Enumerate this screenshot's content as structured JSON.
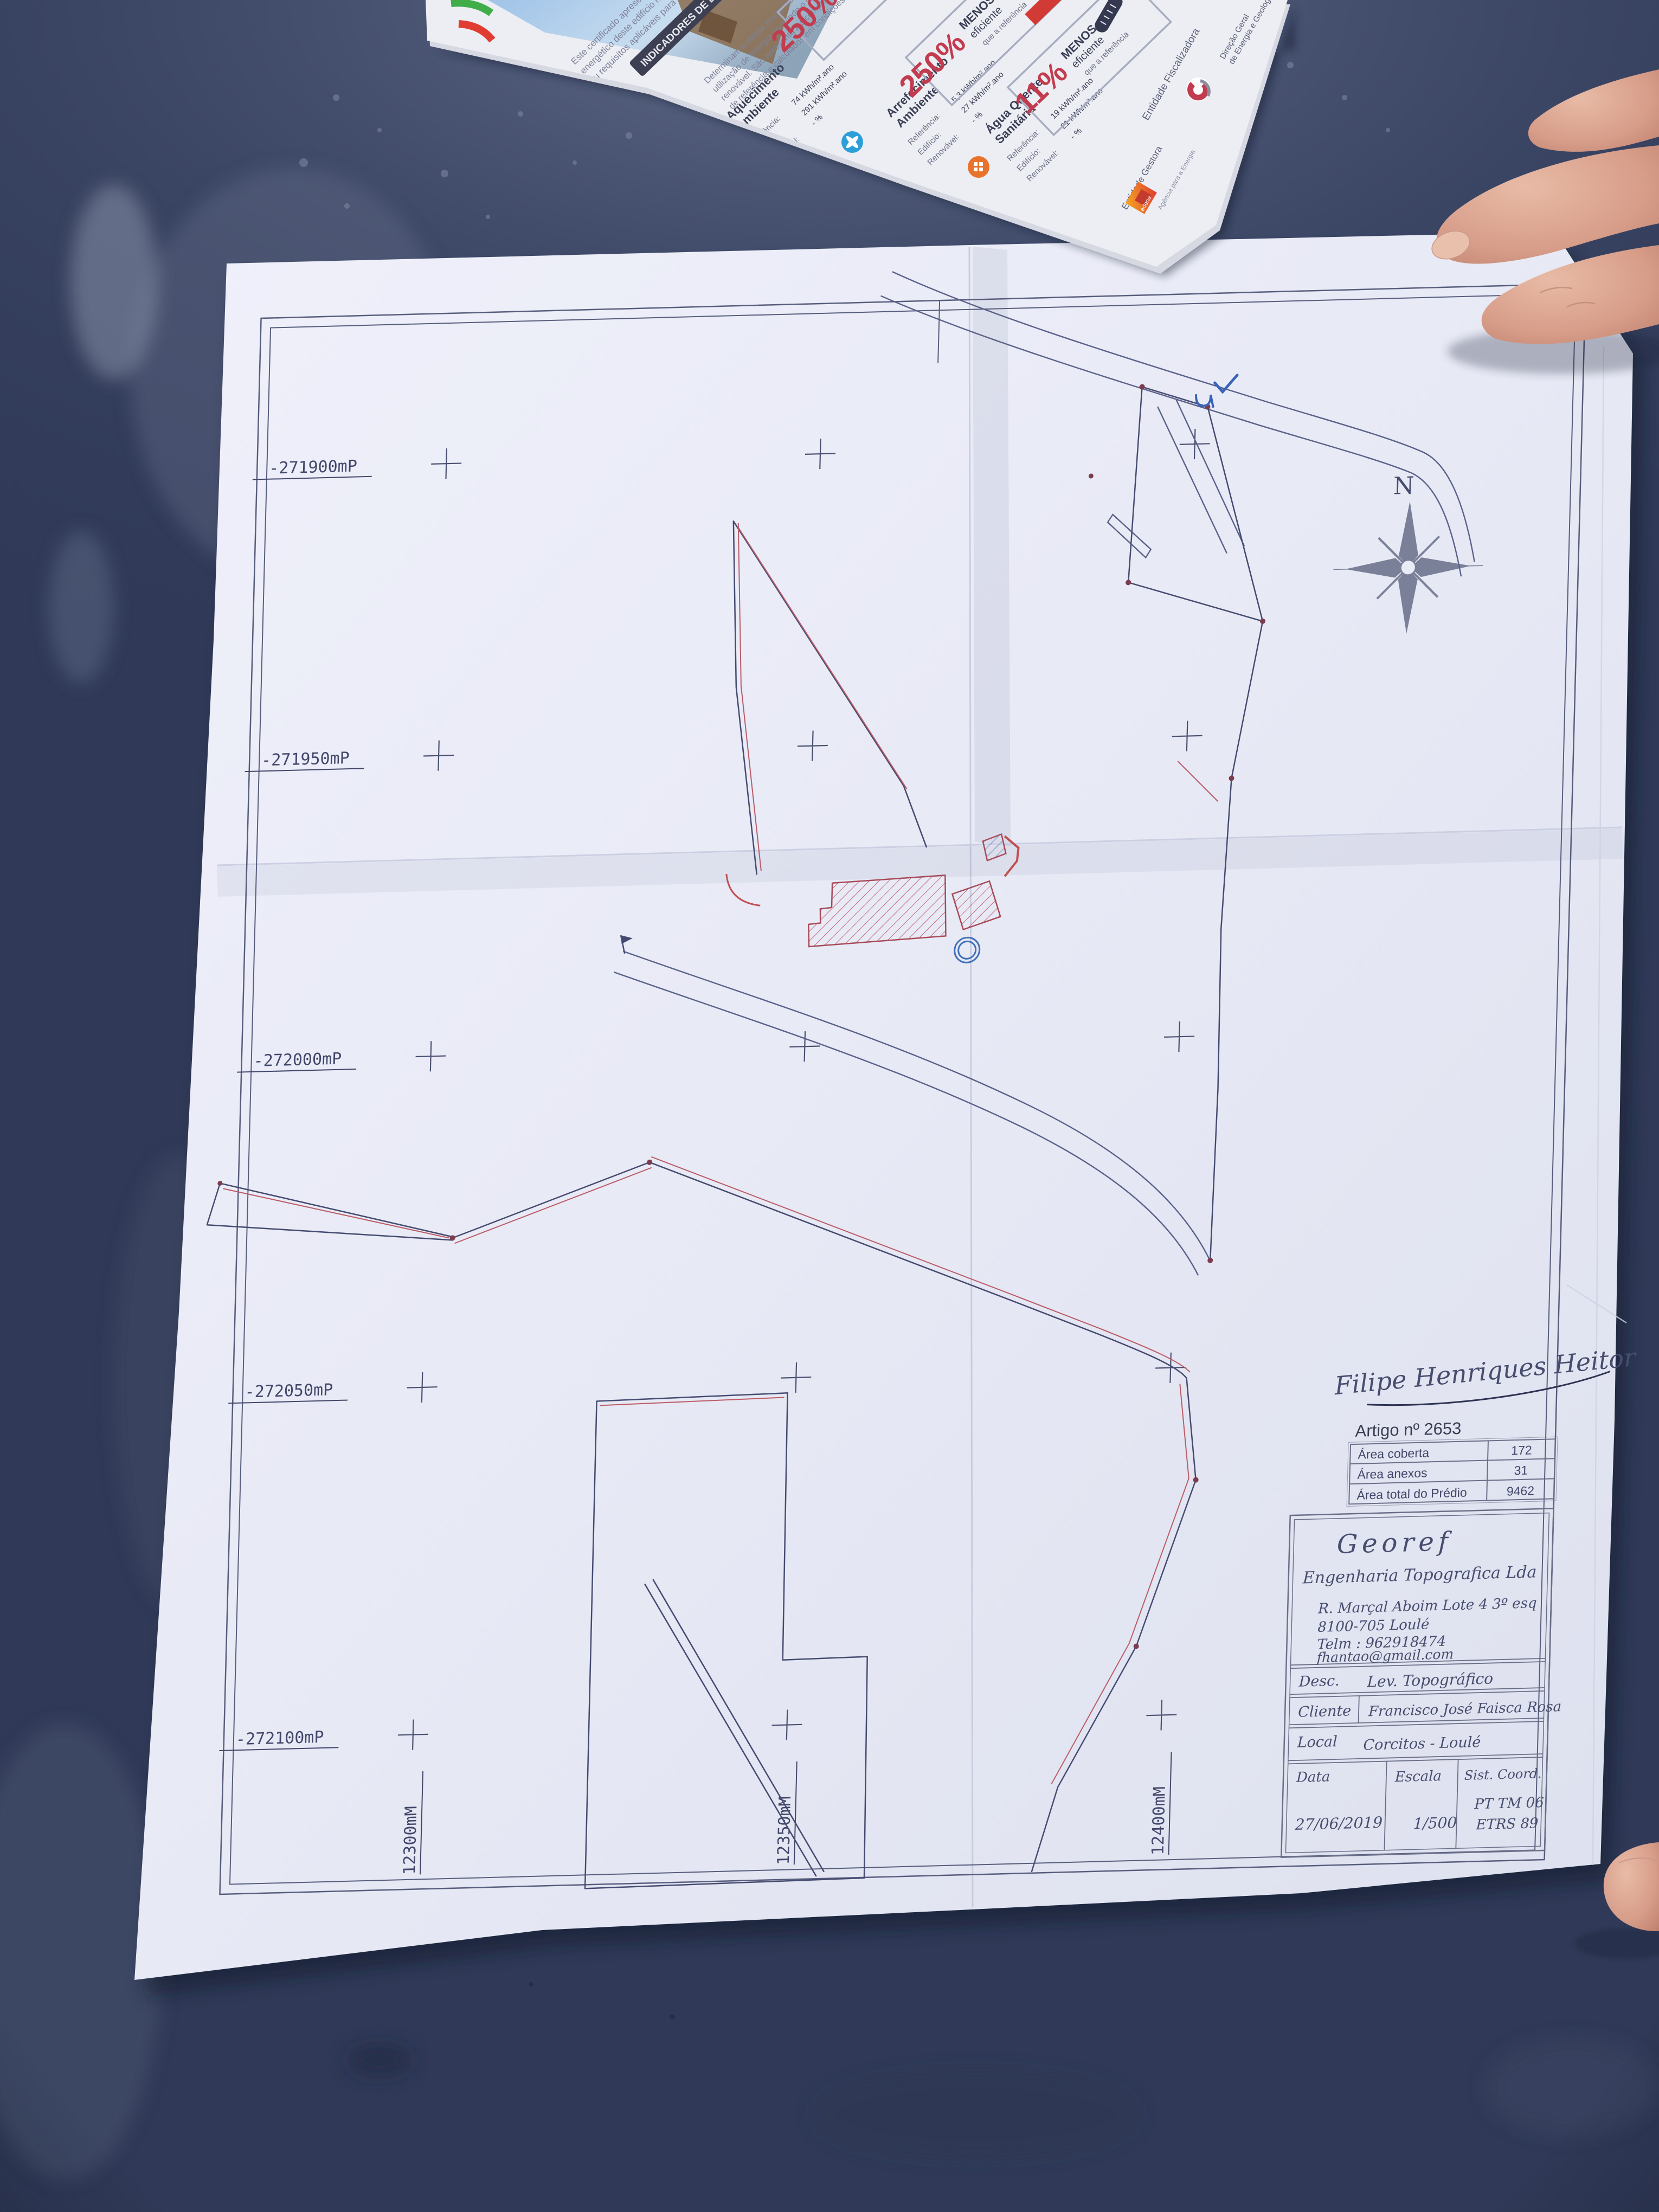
{
  "plan": {
    "north_label": "N",
    "left_coords": [
      "-271900mP",
      "-271950mP",
      "-272000mP",
      "-272050mP",
      "-272100mP"
    ],
    "bottom_coords": [
      "12300mM",
      "12350mM",
      "12400mM"
    ],
    "artigo": {
      "title": "Artigo nº 2653",
      "rows": [
        {
          "label": "Área coberta",
          "value": "172"
        },
        {
          "label": "Área anexos",
          "value": "31"
        },
        {
          "label": "Área total do Prédio",
          "value": "9462"
        }
      ]
    },
    "signature": "Filipe Henriques Heitor",
    "title_block": {
      "company": "Georef",
      "company_sub": "Engenharia Topografica Lda",
      "address1": "R. Marçal Aboim Lote 4 3º esq",
      "address2": "8100-705 Loulé",
      "phone": "Telm : 962918474",
      "email": "fhantao@gmail.com",
      "desc_label": "Desc.",
      "desc_value": "Lev. Topográfico",
      "client_label": "Cliente",
      "client_value": "Francisco José Faisca Rosa",
      "local_label": "Local",
      "local_value": "Corcitos - Loulé",
      "date_label": "Data",
      "date_value": "27/06/2019",
      "scale_label": "Escala",
      "scale_value": "1/500",
      "coord_sys_label": "Sist. Coord.",
      "coord_sys_value1": "PT TM 06",
      "coord_sys_value2": "ETRS 89"
    }
  },
  "brochure": {
    "heading": "INDICADORES DE DESEMPENHO",
    "intro": [
      "Este certificado apresenta a classe",
      "energético deste edifício nas condições",
      "ou requisitos aplicáveis para o ano"
    ],
    "body": [
      "Determinam a classe energética do edifício",
      "utilização de energia, incluindo o consumo",
      "renovável. São apresentados comparativos",
      "de referência e calculados em condições"
    ],
    "sections": [
      {
        "name1": "Aquecimento",
        "name2": "Ambiente",
        "ref_label": "Referência:",
        "ref": "74 kWh/m².ano",
        "ed_label": "Edifício:",
        "ed": "291 kWh/m².ano",
        "ren_label": "Renovável:",
        "ren": "- %"
      },
      {
        "name1": "Arrefecimento",
        "name2": "Ambiente",
        "ref_label": "Referência:",
        "ref": "5,3 kWh/m².ano",
        "ed_label": "Edifício:",
        "ed": "27 kWh/m².ano",
        "ren_label": "Renovável:",
        "ren": "- %"
      },
      {
        "name1": "Água Quente",
        "name2": "Sanitária",
        "ref_label": "Referência:",
        "ref": "19 kWh/m².ano",
        "ed_label": "Edifício:",
        "ed": "21 kWh/m².ano",
        "ren_label": "Renovável:",
        "ren": "- %"
      }
    ],
    "badges": [
      {
        "pct": "250%",
        "line1": "MENOS",
        "line2": "eficiente",
        "line3": "que a referência"
      },
      {
        "pct": "250%",
        "line1": "MENOS",
        "line2": "eficiente",
        "line3": "que a referência"
      },
      {
        "pct": "11%",
        "line1": "MENOS",
        "line2": "eficiente",
        "line3": "que a referência"
      }
    ],
    "entity1_label": "Entidade Fiscalizadora",
    "entity1_name1": "Direção Geral",
    "entity1_name2": "de Energia e Geologia",
    "entity2_label": "Entidade Gestora",
    "entity2_name": "adene",
    "entity2_sub": "Agência para a Energia"
  },
  "colors": {
    "accent_red": "#c23b4e",
    "ink_blue": "#454b70",
    "parcel_red": "#bb5c66",
    "road_blue": "#5a628a",
    "table_dark": "#303a58"
  }
}
